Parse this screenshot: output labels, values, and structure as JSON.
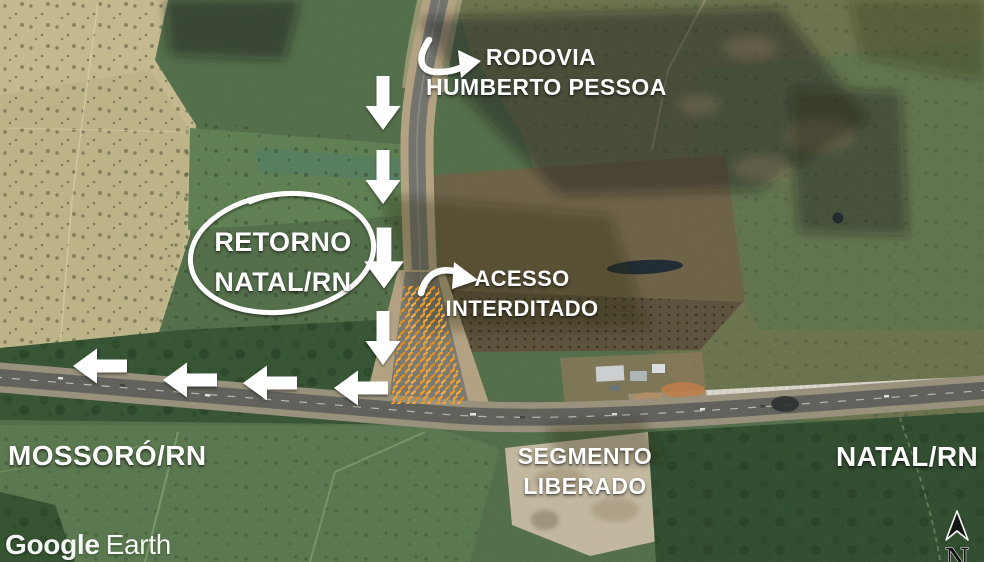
{
  "map": {
    "attribution": {
      "brand": "Google",
      "product": "Earth"
    },
    "compass_letter": "N"
  },
  "labels": {
    "rodovia_line1": "RODOVIA",
    "rodovia_line2": "HUMBERTO PESSOA",
    "retorno_line1": "RETORNO",
    "retorno_line2": "NATAL/RN",
    "acesso_line1": "ACESSO",
    "acesso_line2": "INTERDITADO",
    "mossoro": "MOSSORÓ/RN",
    "segmento_line1": "SEGMENTO",
    "segmento_line2": "LIBERADO",
    "natal": "NATAL/RN"
  },
  "icons": {
    "arrow-down-icon": "⬇",
    "arrow-left-icon": "⬅",
    "curved-arrow-icon": "↷",
    "north-arrow-icon": "▲",
    "circle-highlight-icon": "◯"
  },
  "colors": {
    "annotation_white": "#ffffff",
    "barrier_orange": "#ef9c2b",
    "field_green": "#4e6b44",
    "field_tan": "#c6b98d",
    "forest_green": "#30502d"
  }
}
